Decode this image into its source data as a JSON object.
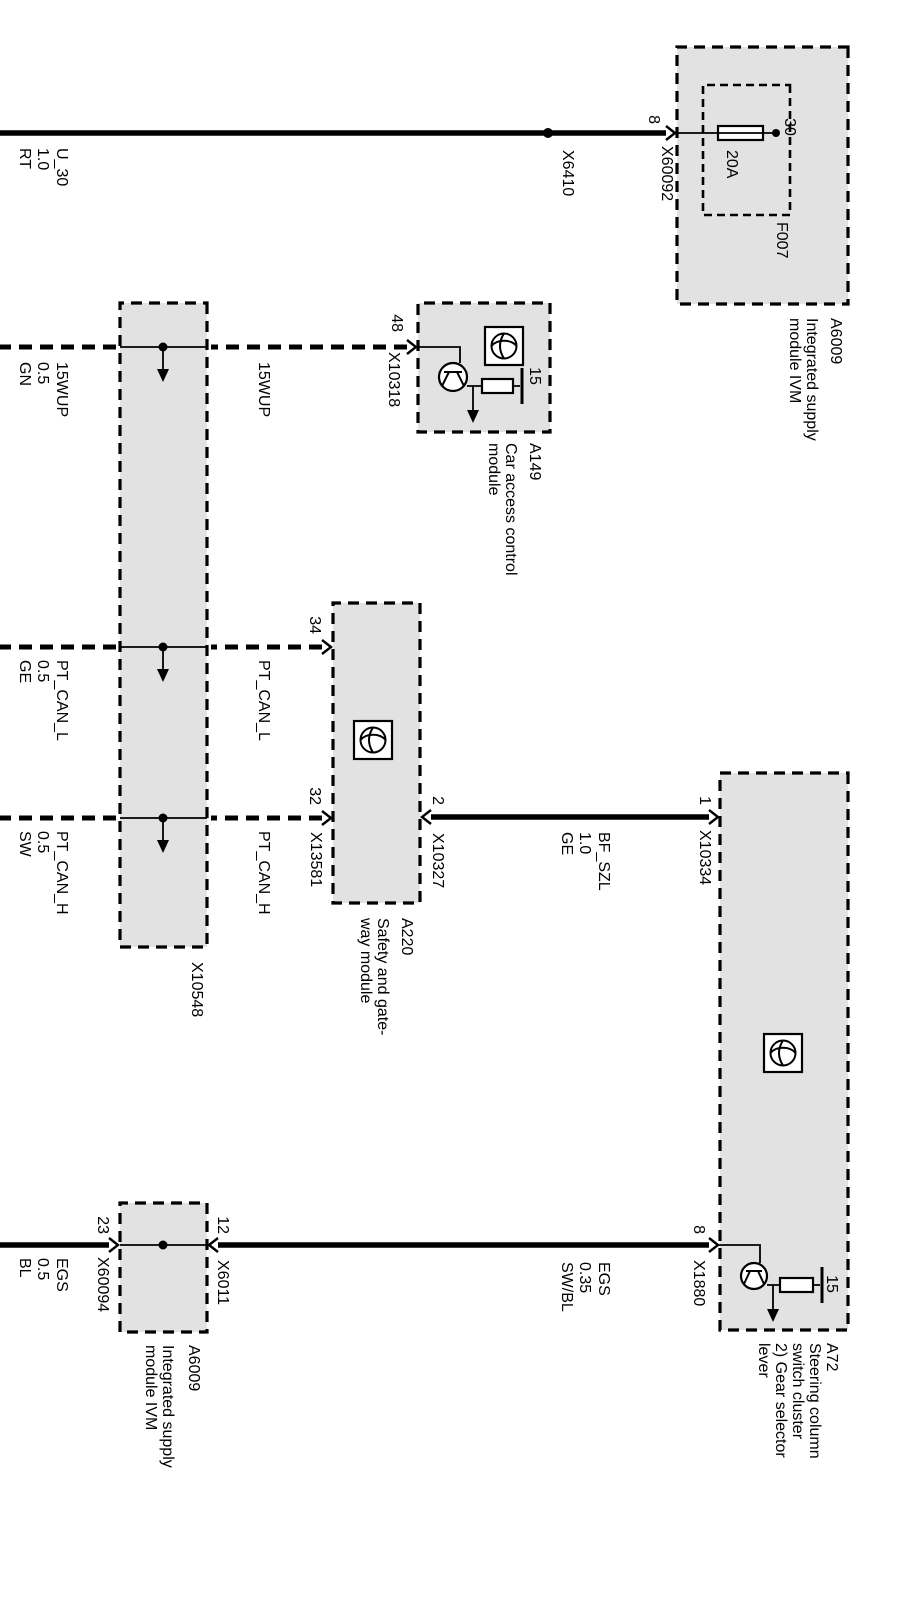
{
  "diagram": {
    "ivm_top": {
      "id": "A6009",
      "line1": "Integrated supply",
      "line2": "module IVM",
      "pin": "8",
      "connector": "X60092",
      "fuse": {
        "id": "F007",
        "rating": "20A",
        "terminal": "30"
      }
    },
    "splice_x6410": "X6410",
    "a149": {
      "id": "A149",
      "line1": "Car access control",
      "line2": "module",
      "pin": "48",
      "connector": "X10318",
      "terminal": "15"
    },
    "a220": {
      "id": "A220",
      "line1": "Safety and gate-",
      "line2": "way module",
      "pin34": "34",
      "pin32": "32",
      "pin2": "2",
      "connector_bottom": "X13581",
      "connector_top": "X10327"
    },
    "a72": {
      "id": "A72",
      "line1": "Steering column",
      "line2": "switch cluster",
      "line3": "2) Gear selector",
      "line4": "lever",
      "pin1": "1",
      "connector1": "X10334",
      "pin8": "8",
      "connector8": "X1880",
      "terminal": "15"
    },
    "x10548": {
      "id": "X10548"
    },
    "ivm_bottom": {
      "id": "A6009",
      "line1": "Integrated supply",
      "line2": "module IVM",
      "pin23": "23",
      "connector23": "X60094",
      "pin12": "12",
      "connector12": "X6011"
    },
    "wires": {
      "u30": {
        "name": "U_30",
        "size": "1.0",
        "color": "RT"
      },
      "wup": {
        "name": "15WUP",
        "size": "0.5",
        "color": "GN",
        "mid": "15WUP"
      },
      "canl": {
        "name": "PT_CAN_L",
        "size": "0.5",
        "color": "GE",
        "mid": "PT_CAN_L"
      },
      "canh": {
        "name": "PT_CAN_H",
        "size": "0.5",
        "color": "SW",
        "mid": "PT_CAN_H"
      },
      "bfszl": {
        "name": "BF_SZL",
        "size": "1.0",
        "color": "GE"
      },
      "egs_upper": {
        "name": "EGS",
        "size": "0.35",
        "color": "SW/BL"
      },
      "egs_lower": {
        "name": "EGS",
        "size": "0.5",
        "color": "BL"
      }
    },
    "colors": {
      "box_fill": "#e2e2e2",
      "ink": "#000000",
      "bg": "#ffffff"
    }
  }
}
